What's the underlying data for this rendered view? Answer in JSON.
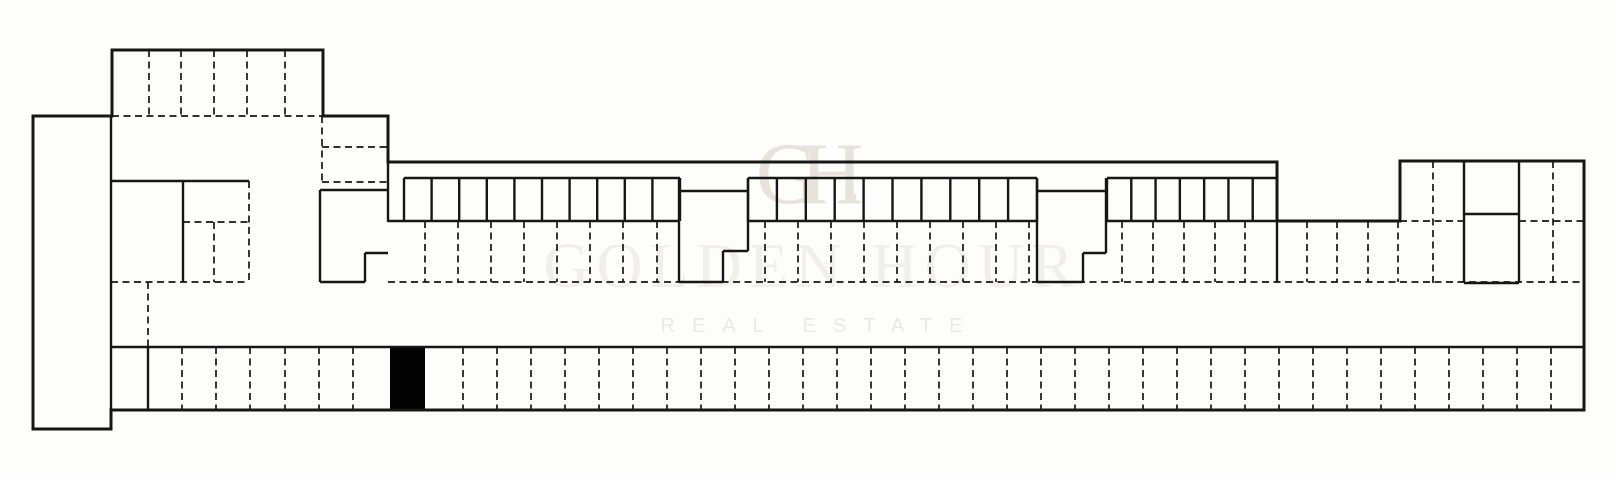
{
  "watermark": {
    "monogram": "GH",
    "title": "GOLDEN HOUR",
    "subtitle": "REAL ESTATE",
    "monogram_color": "#e7e2db",
    "title_color": "#f1efec",
    "subtitle_color": "#ebe9e5"
  },
  "plan": {
    "canvas": {
      "w": 1615,
      "h": 479
    },
    "colors": {
      "background": "#fdfdfc",
      "line": "#161616",
      "highlight": "#030303"
    },
    "outline_points": [
      [
        33,
        116
      ],
      [
        112,
        116
      ],
      [
        112,
        50
      ],
      [
        323,
        50
      ],
      [
        323,
        116
      ],
      [
        388,
        116
      ],
      [
        388,
        162
      ],
      [
        1277,
        162
      ],
      [
        1277,
        221
      ],
      [
        1400,
        221
      ],
      [
        1400,
        161
      ],
      [
        1584,
        161
      ],
      [
        1584,
        410
      ],
      [
        111,
        410
      ],
      [
        111,
        429
      ],
      [
        33,
        429
      ]
    ],
    "solid_segments": [
      [
        111,
        116,
        111,
        410
      ],
      [
        111,
        181,
        249,
        181
      ],
      [
        183,
        181,
        183,
        282
      ],
      [
        320,
        190,
        388,
        190
      ],
      [
        320,
        190,
        320,
        282
      ],
      [
        320,
        282,
        365,
        282
      ],
      [
        365,
        253,
        365,
        282
      ],
      [
        365,
        253,
        388,
        253
      ],
      [
        388,
        116,
        388,
        222
      ],
      [
        388,
        221,
        680,
        221
      ],
      [
        748,
        221,
        1037,
        221
      ],
      [
        1107,
        221,
        1400,
        221
      ],
      [
        679,
        178,
        679,
        282
      ],
      [
        679,
        282,
        723,
        282
      ],
      [
        723,
        251,
        723,
        282
      ],
      [
        723,
        251,
        748,
        251
      ],
      [
        748,
        178,
        748,
        251
      ],
      [
        679,
        191,
        748,
        191
      ],
      [
        1037,
        178,
        1037,
        282
      ],
      [
        1037,
        282,
        1083,
        282
      ],
      [
        1083,
        253,
        1083,
        282
      ],
      [
        1083,
        253,
        1106,
        253
      ],
      [
        1106,
        178,
        1106,
        253
      ],
      [
        1037,
        191,
        1106,
        191
      ],
      [
        1277,
        221,
        1277,
        282
      ],
      [
        1464,
        161,
        1464,
        283
      ],
      [
        1519,
        161,
        1519,
        283
      ],
      [
        1464,
        214,
        1519,
        214
      ],
      [
        1464,
        283,
        1519,
        283
      ],
      [
        111,
        347,
        1584,
        347
      ],
      [
        148,
        347,
        148,
        410
      ]
    ],
    "dashed_segments": [
      [
        112,
        116,
        323,
        116
      ],
      [
        322,
        116,
        322,
        182
      ],
      [
        322,
        147,
        388,
        147
      ],
      [
        322,
        182,
        388,
        182
      ],
      [
        249,
        181,
        249,
        282
      ],
      [
        183,
        222,
        249,
        222
      ],
      [
        214,
        222,
        214,
        282
      ],
      [
        111,
        282,
        249,
        282
      ],
      [
        148,
        282,
        148,
        347
      ],
      [
        388,
        282,
        1584,
        282
      ],
      [
        1433,
        161,
        1433,
        283
      ],
      [
        1553,
        161,
        1553,
        283
      ],
      [
        1400,
        221,
        1464,
        221
      ],
      [
        1519,
        221,
        1584,
        221
      ]
    ],
    "stall_groups": [
      {
        "x1": 404,
        "x2": 680,
        "count": 10,
        "y1": 178,
        "y2": 221
      },
      {
        "x1": 748,
        "x2": 1037,
        "count": 10,
        "y1": 178,
        "y2": 221
      },
      {
        "x1": 1107,
        "x2": 1277,
        "count": 7,
        "y1": 178,
        "y2": 221
      }
    ],
    "dashed_vertical_sets": [
      {
        "xs": [
          149,
          181,
          214,
          247,
          285
        ],
        "y1": 50,
        "y2": 116
      },
      {
        "xs": [
          425,
          458,
          491,
          524,
          557,
          590,
          623,
          657,
          765,
          798,
          831,
          864,
          897,
          930,
          963,
          996,
          1029,
          1122,
          1153,
          1184,
          1215,
          1245,
          1307,
          1337,
          1368,
          1398
        ],
        "y1": 221,
        "y2": 282
      },
      {
        "xs": [
          182,
          216,
          250,
          285,
          319,
          353,
          463,
          497,
          531,
          565,
          599,
          633,
          667,
          701,
          735,
          769,
          803,
          837,
          871,
          905,
          939,
          973,
          1007,
          1041,
          1075,
          1109,
          1143,
          1177,
          1211,
          1245,
          1279,
          1313,
          1347,
          1381,
          1415,
          1449,
          1483,
          1517,
          1551
        ],
        "y1": 347,
        "y2": 410
      }
    ],
    "highlight_stall": {
      "x": 390,
      "y": 348,
      "w": 35,
      "h": 62
    }
  }
}
